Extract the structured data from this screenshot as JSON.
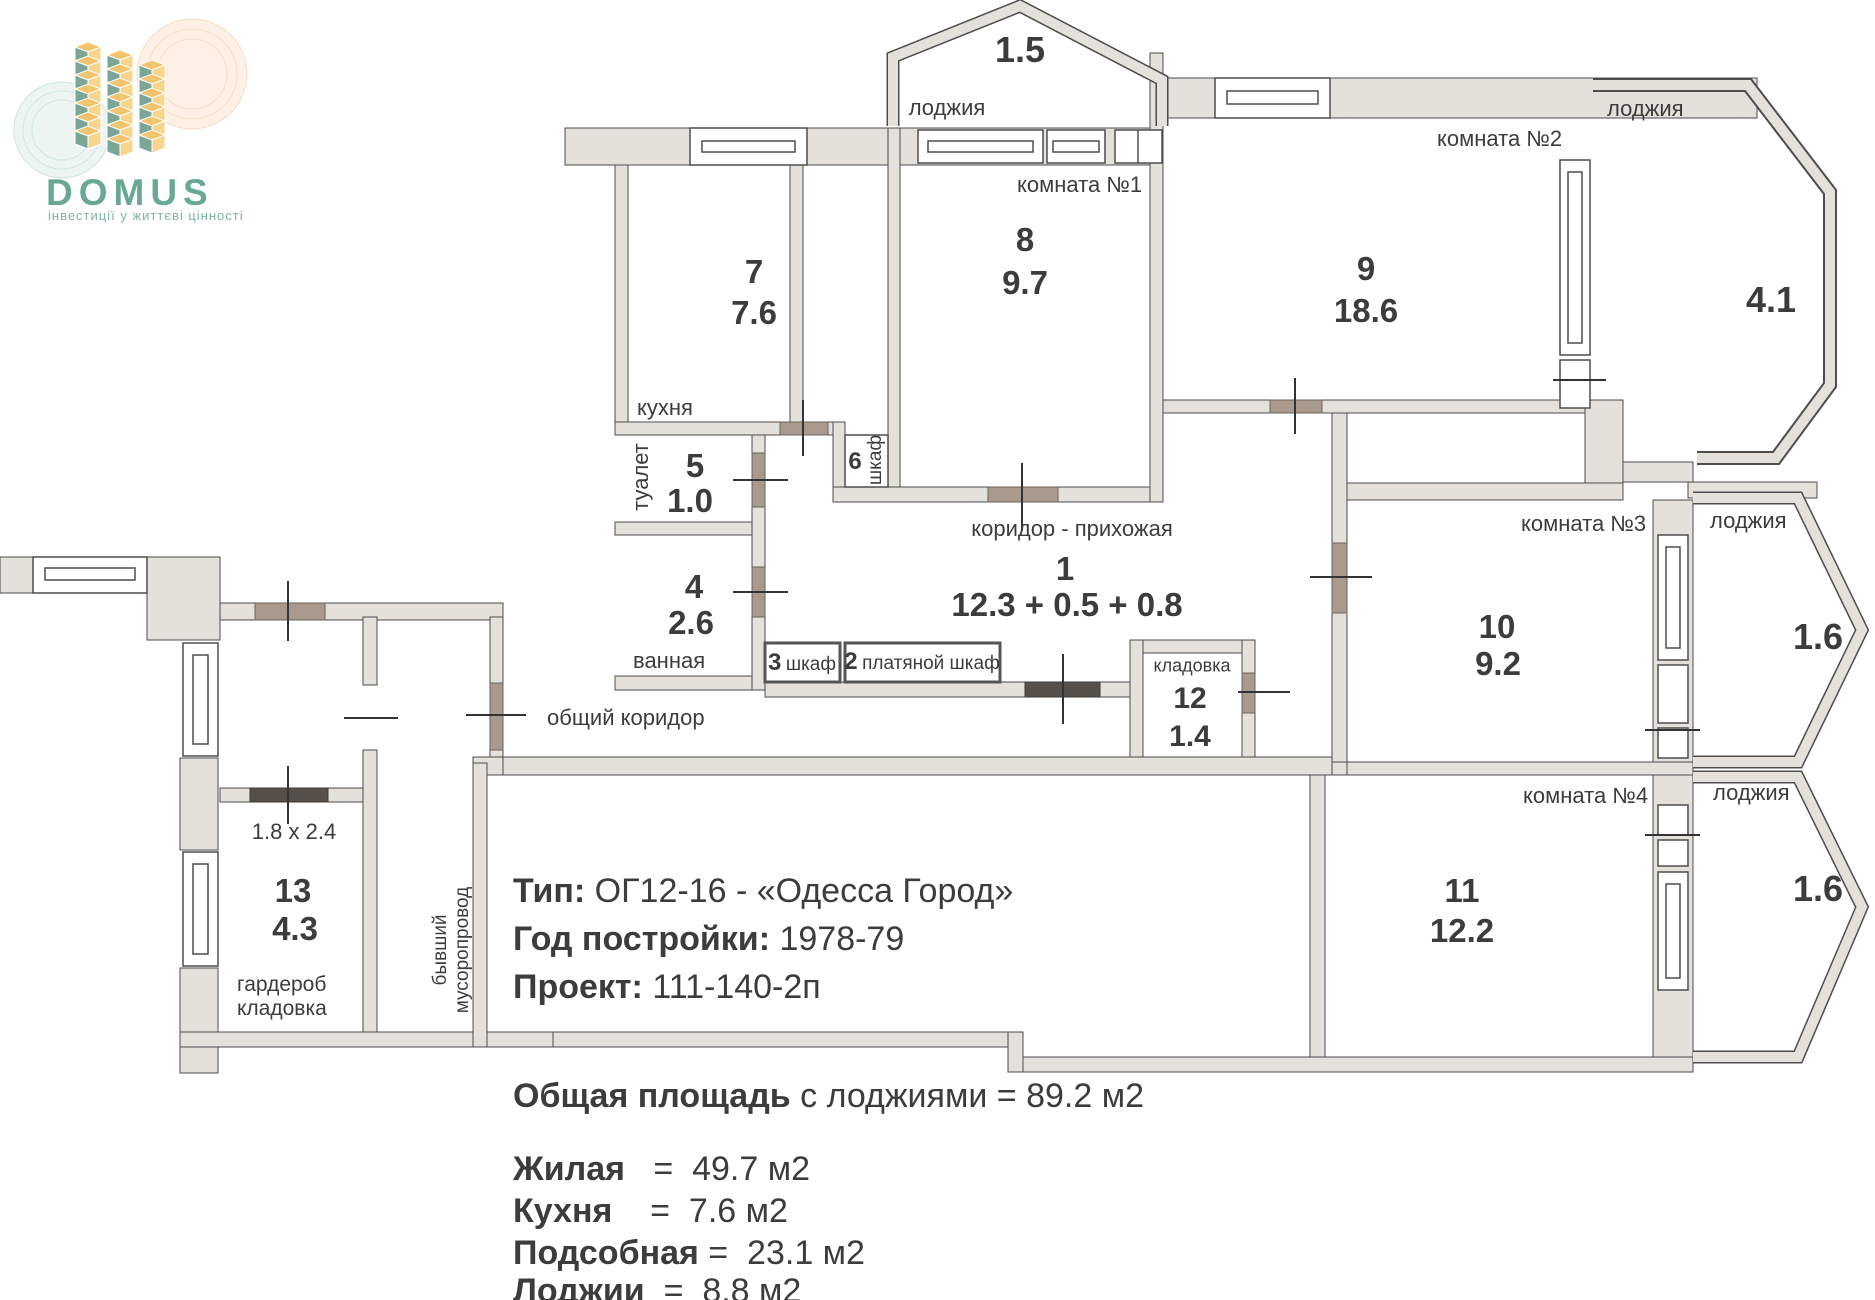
{
  "logo": {
    "name": "DOMUS",
    "tagline": "інвестиції у життєві цінності",
    "brand_color": "#69a893",
    "block_yellow": "#f2c46d",
    "block_teal": "#7aa69a"
  },
  "plan": {
    "loggia_top": {
      "label": "лоджия",
      "area": "1.5"
    },
    "kitchen": {
      "label": "кухня",
      "number": "7",
      "area": "7.6"
    },
    "room1": {
      "label": "комната №1",
      "number": "8",
      "area": "9.7"
    },
    "room2": {
      "label": "комната №2",
      "number": "9",
      "area": "18.6"
    },
    "loggia_right": {
      "label": "лоджия",
      "area": "4.1"
    },
    "toilet": {
      "label": "туалет",
      "number": "5",
      "area": "1.0"
    },
    "bath": {
      "label": "ванная",
      "number": "4",
      "area": "2.6"
    },
    "closet6": {
      "label": "шкаф",
      "number": "6"
    },
    "hall": {
      "label": "коридор - прихожая",
      "number": "1",
      "area": "12.3 + 0.5 + 0.8"
    },
    "closet3": {
      "label": "шкаф",
      "number": "3"
    },
    "closet2": {
      "label": "платяной шкаф",
      "number": "2"
    },
    "pantry": {
      "label": "кладовка",
      "number": "12",
      "area": "1.4"
    },
    "room3": {
      "label": "комната №3",
      "number": "10",
      "area": "9.2"
    },
    "loggia_mid": {
      "label": "лоджия",
      "area": "1.6"
    },
    "room4": {
      "label": "комната №4",
      "number": "11",
      "area": "12.2"
    },
    "loggia_low": {
      "label": "лоджия",
      "area": "1.6"
    },
    "wardrobe": {
      "dim": "1.8 x 2.4",
      "number": "13",
      "area": "4.3",
      "label1": "гардероб",
      "label2": "кладовка"
    },
    "chute": {
      "label1": "бывший",
      "label2": "мусоропровод"
    },
    "common_corridor": {
      "label": "общий коридор"
    }
  },
  "info": {
    "type_label": "Тип:",
    "type_value": " ОГ12-16 - «Одесса Город»",
    "year_label": "Год постройки:",
    "year_value": " 1978-79",
    "project_label": "Проект:",
    "project_value": " 111-140-2п"
  },
  "summary": {
    "total_label": "Общая площадь",
    "total_value": " с лоджиями = 89.2 м2",
    "rows": [
      {
        "label": "Жилая",
        "value": "   =  49.7 м2"
      },
      {
        "label": "Кухня",
        "value": "    =  7.6 м2"
      },
      {
        "label": "Подсобная",
        "value": " =  23.1 м2"
      },
      {
        "label": "Лоджии",
        "value": "  =  8.8 м2"
      }
    ]
  }
}
